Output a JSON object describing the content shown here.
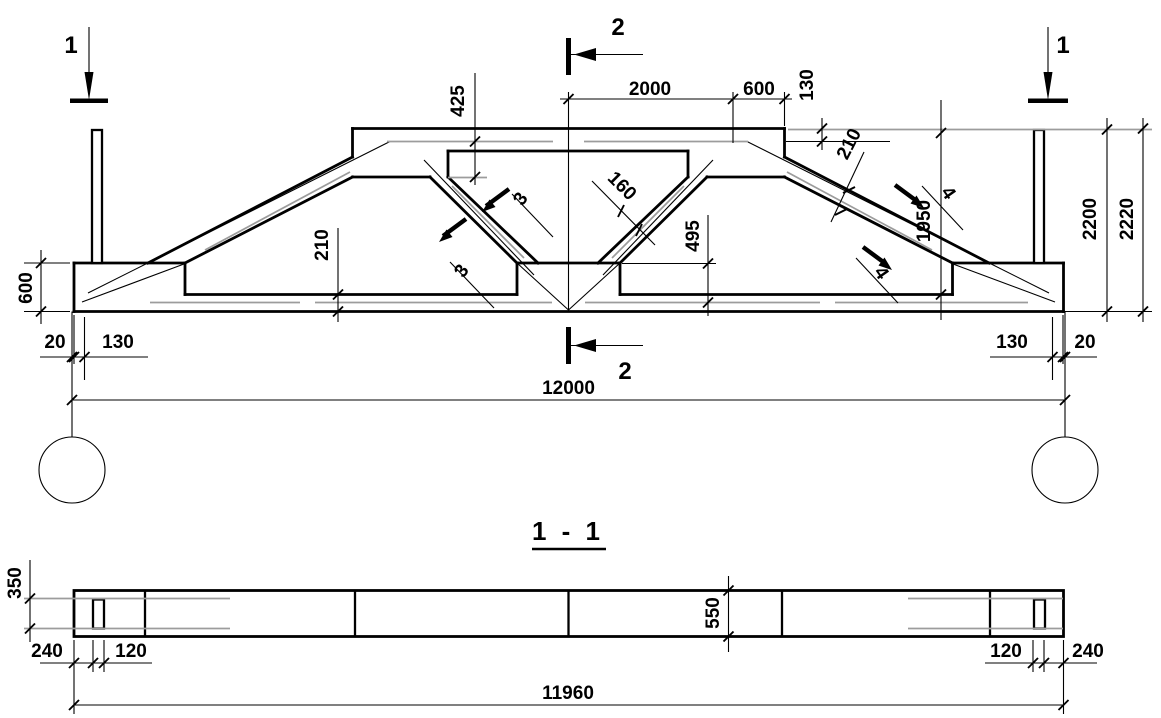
{
  "drawing_type": "truss elevation and plan section, reinforced concrete girder",
  "elevation": {
    "section_markers": {
      "left": "1",
      "right": "1",
      "top": "2",
      "bottom": "2"
    },
    "cut_marks": {
      "web": "3",
      "slope": "4"
    },
    "dims": {
      "top_chord_inner_offset": "425",
      "half_span_top": "2000",
      "top_end_segment": "600",
      "top_step": "130",
      "web_thickness": "160",
      "slope_thickness": "210",
      "inner_height": "1950",
      "height_to_top": "2200",
      "overall_height": "2220",
      "bottom_chord_thickness": "210",
      "web_to_chord_offset": "495",
      "support_height": "600",
      "left_end_gap": "20",
      "left_axis_inset": "130",
      "right_axis_inset": "130",
      "right_end_gap": "20",
      "span": "12000"
    }
  },
  "section_1_1": {
    "title": "1 - 1",
    "dims": {
      "end_width": "350",
      "middle_width": "550",
      "left_end_offset": "240",
      "left_hole_width": "120",
      "right_hole_width": "120",
      "right_end_offset": "240",
      "member_length": "11960"
    }
  },
  "colors": {
    "ink": "#000000",
    "rebar_gray": "#9c9c9c",
    "background": "#ffffff"
  }
}
